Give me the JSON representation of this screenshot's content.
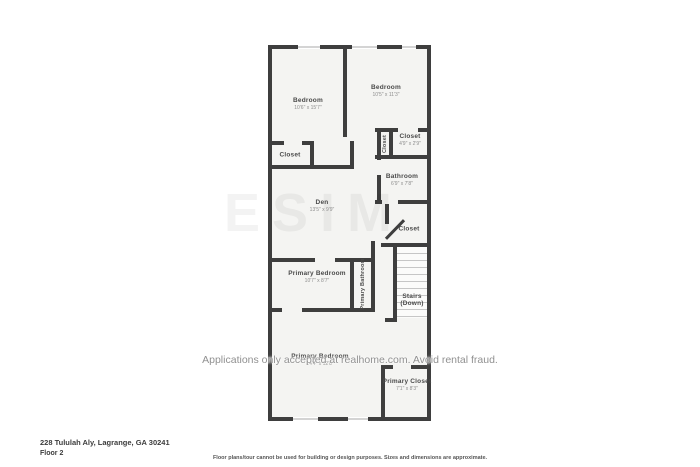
{
  "address": "228 Tululah Aly, Lagrange, GA 30241",
  "floor_label": "Floor 2",
  "disclaimer": "Floor plans/tour cannot be used for building or design purposes. Sizes and dimensions are approximate.",
  "watermark_text": "Applications only accepted at realhome.com. Avoid rental fraud.",
  "logo_watermark": "ESIM",
  "colors": {
    "wall": "#3e3e3e",
    "floor": "#f4f4f2",
    "label": "#4a4a4a",
    "dims": "#8d8d8d"
  },
  "rooms": {
    "bedroom_left": {
      "name": "Bedroom",
      "dims": "10'6\" x 15'7\""
    },
    "bedroom_right": {
      "name": "Bedroom",
      "dims": "10'5\" x 11'3\""
    },
    "closet_left": {
      "name": "Closet"
    },
    "closet_vertical": {
      "name": "Closet"
    },
    "closet_small": {
      "name": "Closet",
      "dims": "4'9\" x 2'9\""
    },
    "bathroom": {
      "name": "Bathroom",
      "dims": "6'9\" x 7'8\""
    },
    "den": {
      "name": "Den",
      "dims": "13'5\" x 9'9\""
    },
    "closet_mid": {
      "name": "Closet"
    },
    "primary_bedroom_mid": {
      "name": "Primary Bedroom",
      "dims": "10'7\" x 8'7\""
    },
    "primary_bathroom": {
      "name": "Primary Bathroom"
    },
    "stairs": {
      "name": "Stairs",
      "sub": "(Down)"
    },
    "primary_bedroom_bottom": {
      "name": "Primary Bedroom",
      "dims": "14'4\" x 12'8\""
    },
    "primary_closet": {
      "name": "Primary Closet",
      "dims": "7'1\" x 8'3\""
    }
  }
}
